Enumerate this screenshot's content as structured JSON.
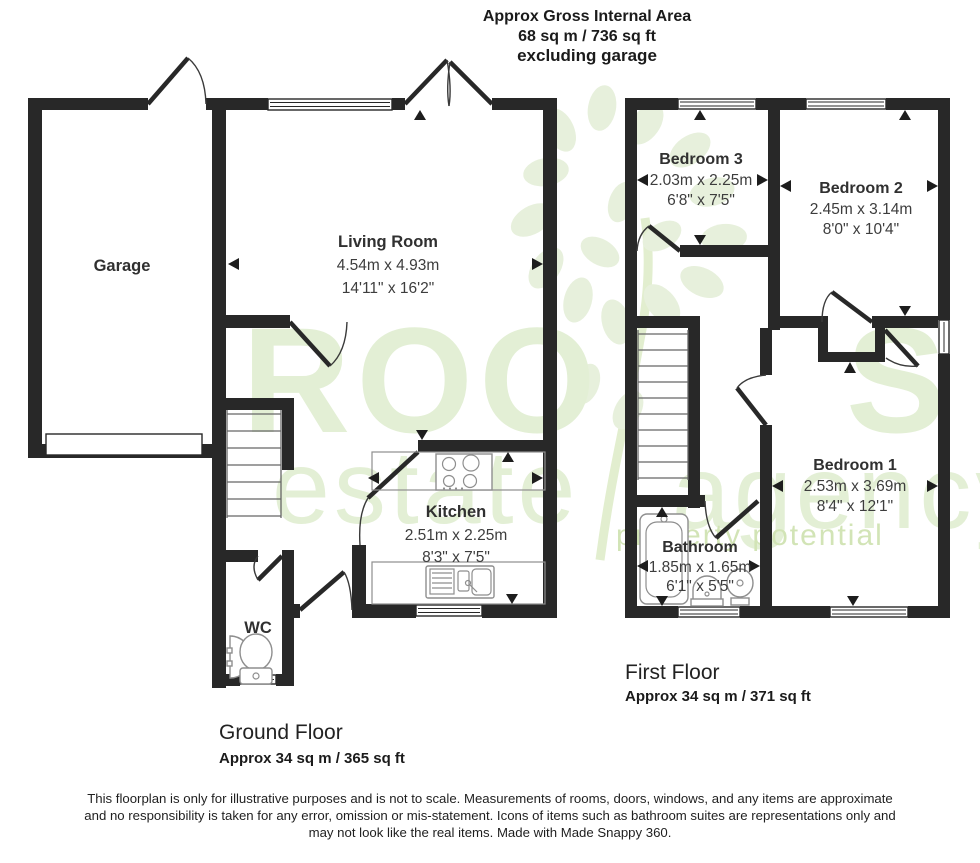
{
  "header": {
    "line1": "Approx Gross Internal Area",
    "line2": "68 sq m / 736 sq ft",
    "line3": "excluding garage"
  },
  "ground_floor": {
    "label": "Ground Floor",
    "area": "Approx 34 sq m / 365 sq ft",
    "rooms": {
      "garage": {
        "name": "Garage"
      },
      "living_room": {
        "name": "Living Room",
        "size_m": "4.54m x 4.93m",
        "size_ft": "14'11\" x 16'2\""
      },
      "kitchen": {
        "name": "Kitchen",
        "size_m": "2.51m x 2.25m",
        "size_ft": "8'3\" x 7'5\""
      },
      "wc": {
        "name": "WC"
      }
    }
  },
  "first_floor": {
    "label": "First Floor",
    "area": "Approx 34 sq m / 371 sq ft",
    "rooms": {
      "bedroom_1": {
        "name": "Bedroom 1",
        "size_m": "2.53m x 3.69m",
        "size_ft": "8'4\" x 12'1\""
      },
      "bedroom_2": {
        "name": "Bedroom 2",
        "size_m": "2.45m x 3.14m",
        "size_ft": "8'0\" x 10'4\""
      },
      "bedroom_3": {
        "name": "Bedroom 3",
        "size_m": "2.03m x 2.25m",
        "size_ft": "6'8\" x 7'5\""
      },
      "bathroom": {
        "name": "Bathroom",
        "size_m": "1.85m x 1.65m",
        "size_ft": "6'1\" x 5'5\""
      }
    }
  },
  "watermark": {
    "brand_part1": "ROO",
    "brand_part2": "S",
    "sub1": "estate",
    "sub2": "agency",
    "tagline": "property potential",
    "color": "#e3efd5"
  },
  "disclaimer": {
    "line1": "This floorplan is only for illustrative purposes and is not to scale. Measurements of rooms, doors, windows, and any items are approximate",
    "line2": "and no responsibility is taken for any error, omission or mis-statement. Icons of items such as bathroom suites are representations only and",
    "line3": "may not look like the real items. Made with Made Snappy 360."
  },
  "colors": {
    "wall": "#282828"
  }
}
